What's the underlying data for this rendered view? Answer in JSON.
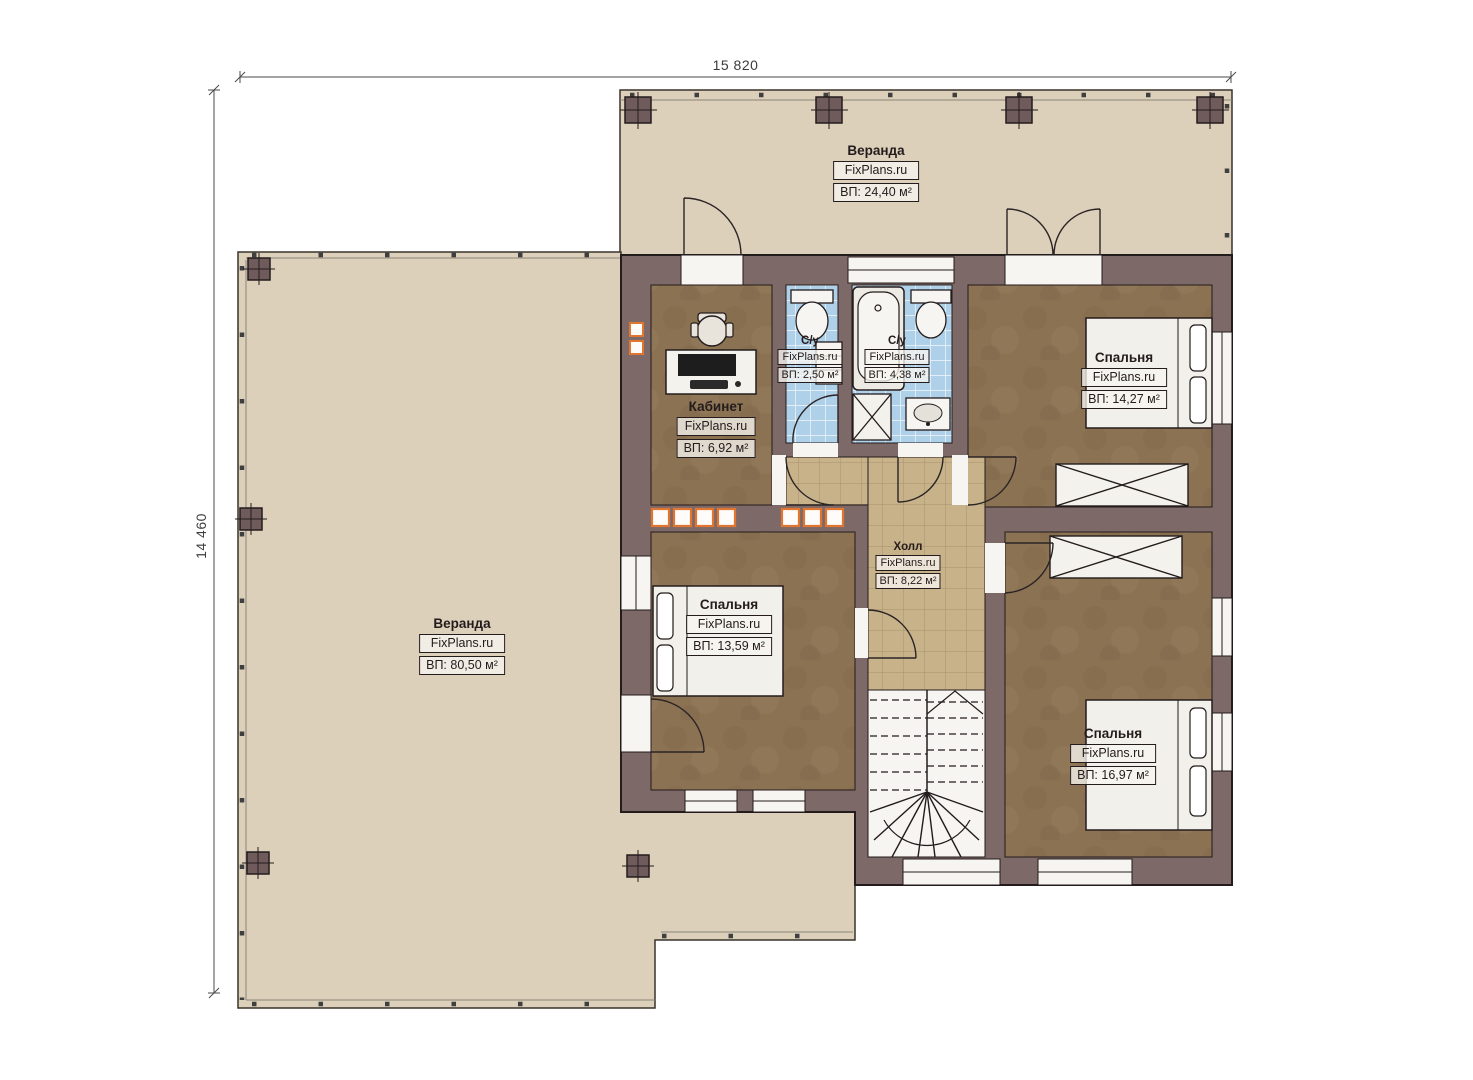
{
  "dimensions": {
    "top": "15 820",
    "left": "14 460"
  },
  "watermark": "FixPlans.ru",
  "rooms": [
    {
      "id": "veranda-top",
      "name": "Веранда",
      "brand": "FixPlans.ru",
      "area": "ВП: 24,40 м²"
    },
    {
      "id": "veranda-left",
      "name": "Веранда",
      "brand": "FixPlans.ru",
      "area": "ВП: 80,50 м²"
    },
    {
      "id": "office",
      "name": "Кабинет",
      "brand": "FixPlans.ru",
      "area": "ВП: 6,92 м²"
    },
    {
      "id": "wc-small",
      "name": "С/у",
      "brand": "FixPlans.ru",
      "area": "ВП: 2,50 м²"
    },
    {
      "id": "bathroom",
      "name": "С/у",
      "brand": "FixPlans.ru",
      "area": "ВП: 4,38 м²"
    },
    {
      "id": "bedroom-top-right",
      "name": "Спальня",
      "brand": "FixPlans.ru",
      "area": "ВП: 14,27 м²"
    },
    {
      "id": "hall",
      "name": "Холл",
      "brand": "FixPlans.ru",
      "area": "ВП: 8,22 м²"
    },
    {
      "id": "bedroom-left",
      "name": "Спальня",
      "brand": "FixPlans.ru",
      "area": "ВП: 13,59 м²"
    },
    {
      "id": "bedroom-bottom-right",
      "name": "Спальня",
      "brand": "FixPlans.ru",
      "area": "ВП: 16,97 м²"
    }
  ],
  "colors": {
    "wall": "#7e6969",
    "outline": "#241c1c",
    "veranda_floor": "#dcd0bb",
    "room_floor": "#8b7253",
    "hall_tile": "#c7b28a",
    "bath_tile": "#aed0e8",
    "flue_accent": "#e0762f"
  }
}
